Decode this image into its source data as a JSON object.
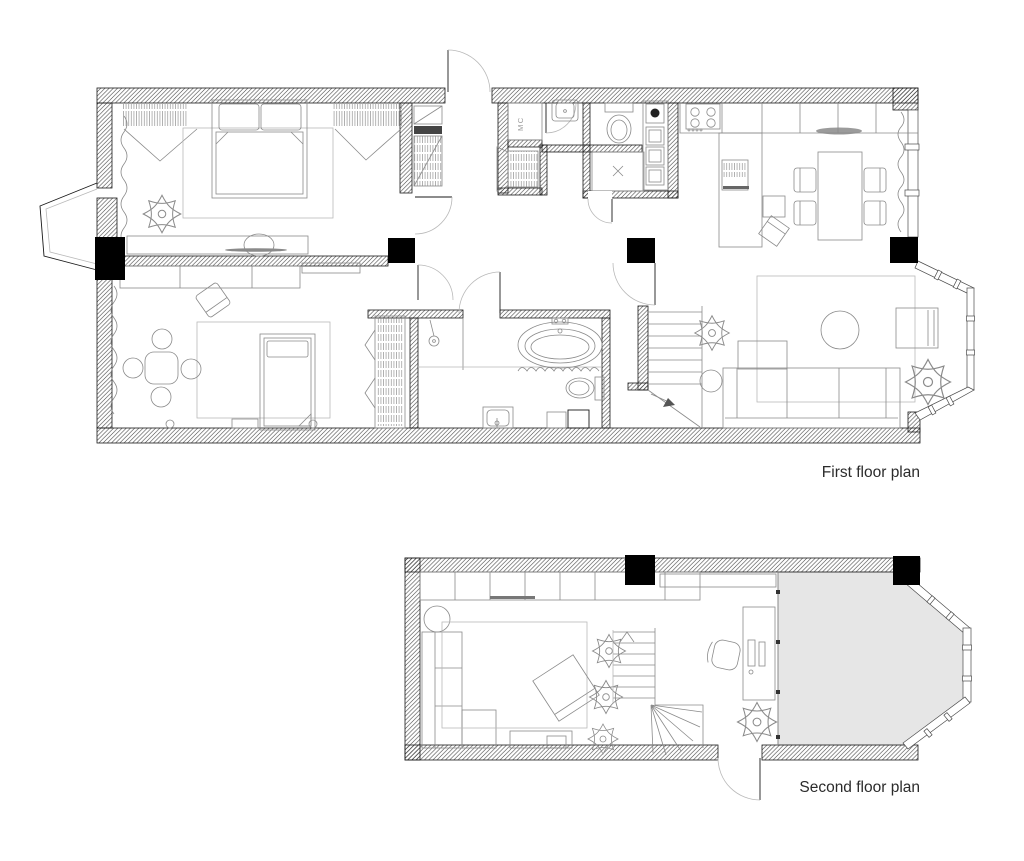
{
  "colors": {
    "background": "#ffffff",
    "line": "#1a1a1a",
    "furniture": "#8a8a8a",
    "column": "#000000",
    "terrace": "#e6e6e6"
  },
  "floors": {
    "first": {
      "label": "First floor plan",
      "utility_label": "MC"
    },
    "second": {
      "label": "Second floor plan"
    }
  }
}
